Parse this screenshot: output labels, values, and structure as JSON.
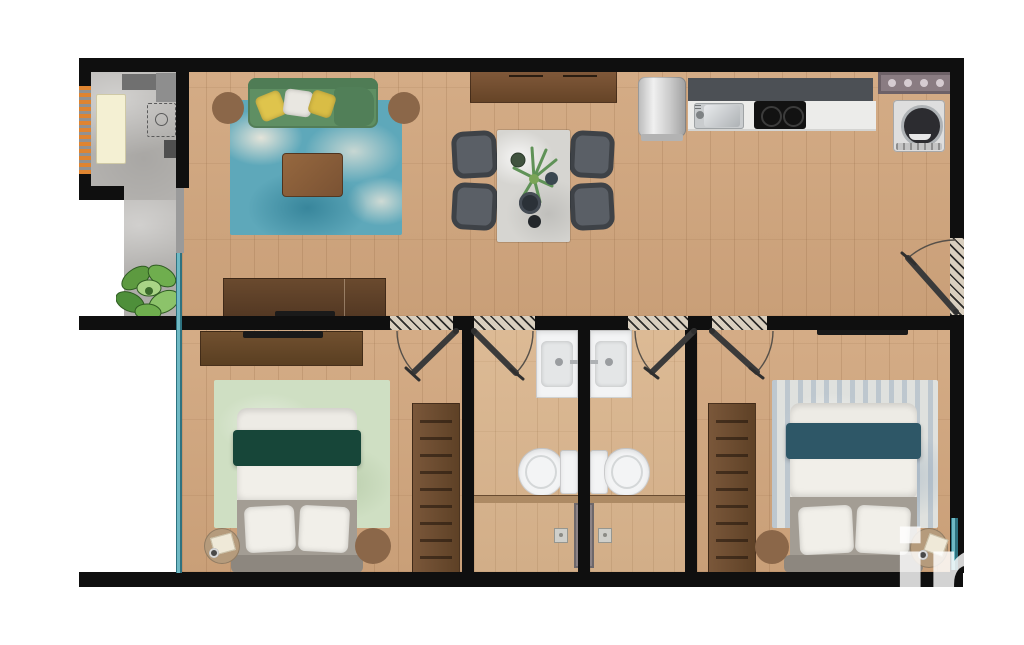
{
  "watermark": {
    "text": "in",
    "color": "#ffffff",
    "opacity": 0.82,
    "font_px": 118
  },
  "palette": {
    "wall": "#0f0f0f",
    "wood_floor": "#d0a883",
    "bath_floor": "#d7b693",
    "concrete": "#b7b5b2",
    "glass_window_teal": "#3f8fa0",
    "accent_orange_louver": "#df8430",
    "sofa_green": "#5f8f63",
    "pillow_yellow": "#dfc44c",
    "rug_blue": "#5ea8ba",
    "rug_sage": "#cfdfc3",
    "rug_heather_blue": "#aebdc9",
    "wood_furniture": "#6d4d33",
    "bed_blanket_emerald": "#174639",
    "bed_blanket_teal": "#2e5767",
    "bed_base_gray": "#a39d94",
    "chair_gray": "#43474d",
    "fixture_white": "#f3f4f5",
    "shower_panel_gray": "#8c8386",
    "cooktop_black": "#121212"
  },
  "rooms": [
    {
      "name": "entry-patio",
      "items": [
        "entry-mat",
        "louver-vent-strip",
        "utility-box-1",
        "utility-box-2",
        "utility-box-3",
        "utility-dashed-outline",
        "potted-plant"
      ]
    },
    {
      "name": "living-room",
      "items": [
        "green-sofa",
        "yellow-pillow",
        "white-pillow",
        "yellow-pillow",
        "blue-area-rug",
        "coffee-table",
        "floor-pouf-left",
        "floor-pouf-right",
        "tv-console",
        "tv"
      ]
    },
    {
      "name": "dining-area",
      "items": [
        "sideboard",
        "dining-table",
        "dining-chair-1",
        "dining-chair-2",
        "dining-chair-3",
        "dining-chair-4",
        "centerpiece-plant",
        "serving-bowl",
        "cup",
        "cup"
      ]
    },
    {
      "name": "kitchen",
      "items": [
        "water-heater-cylinder",
        "upper-cabinet-run",
        "countertop",
        "kitchen-sink",
        "cooktop-2-burner",
        "wall-vent-panel",
        "washing-machine"
      ]
    },
    {
      "name": "bedroom-1",
      "items": [
        "dresser",
        "tv",
        "sage-area-rug",
        "double-bed-green-blanket",
        "wardrobe",
        "nightstand-with-book",
        "floor-pouf",
        "window-wall-west"
      ]
    },
    {
      "name": "bathroom-1",
      "items": [
        "vanity-sink",
        "toilet",
        "shower-threshold",
        "floor-drain",
        "shower-area"
      ]
    },
    {
      "name": "bathroom-2",
      "items": [
        "vanity-sink",
        "toilet",
        "shower-threshold",
        "floor-drain",
        "shower-area"
      ]
    },
    {
      "name": "bedroom-2",
      "items": [
        "wall-tv",
        "heather-blue-area-rug",
        "double-bed-teal-blanket",
        "wardrobe",
        "nightstand-with-decor",
        "floor-pouf",
        "window-east"
      ]
    },
    {
      "name": "shared-core",
      "items": [
        "shower-plumbing-panel-4-jets",
        "entry-door-swing",
        "bedroom-1-door-swing",
        "bathroom-1-door-swing",
        "bathroom-2-door-swing",
        "bedroom-2-door-swing"
      ]
    }
  ],
  "doors": {
    "count": 5,
    "style": "open-leaf-with-swing-arc-and-hatched-opening"
  }
}
